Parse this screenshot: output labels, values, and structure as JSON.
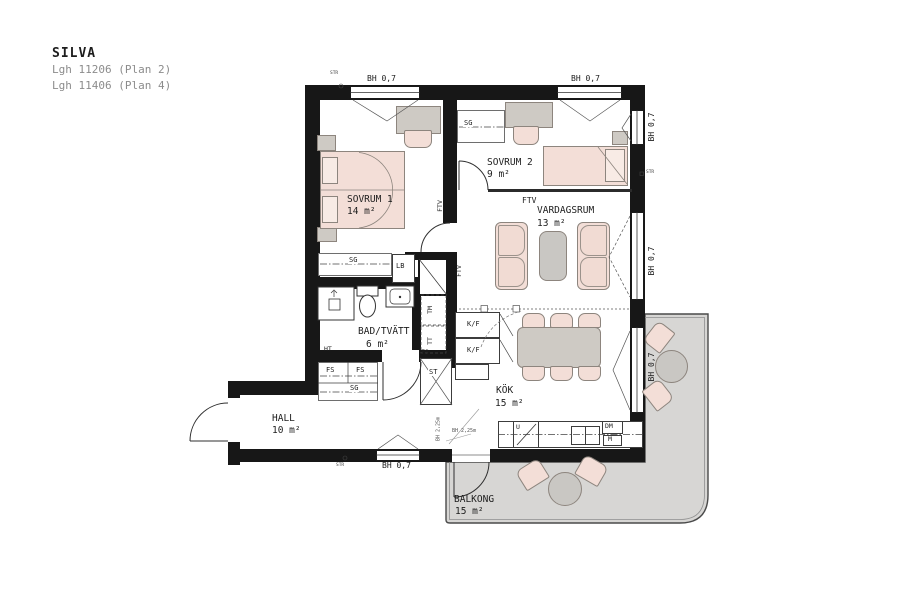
{
  "title": {
    "project": "SILVA",
    "lines": [
      "Lgh 11206 (Plan 2)",
      "Lgh 11406 (Plan 4)"
    ]
  },
  "rooms": {
    "sovrum1": {
      "name": "SOVRUM 1",
      "area": "14 m²"
    },
    "sovrum2": {
      "name": "SOVRUM 2",
      "area": "9 m²"
    },
    "vardagsrum": {
      "name": "VARDAGSRUM",
      "area": "13 m²"
    },
    "bad": {
      "name": "BAD/TVÄTT",
      "area": "6 m²"
    },
    "hall": {
      "name": "HALL",
      "area": "10 m²"
    },
    "kok": {
      "name": "KÖK",
      "area": "15 m²"
    },
    "balkong": {
      "name": "BALKONG",
      "area": "15 m²"
    }
  },
  "labels": {
    "bh07": "BH 0,7",
    "bh225": "BH 2,25m",
    "sg": "SG",
    "lb": "LB",
    "ftv": "FTV",
    "tm": "TM",
    "tt": "TT",
    "fs": "FS",
    "kf": "K/F",
    "st": "ST",
    "ht": "HT",
    "dm": "DM",
    "m": "M",
    "u": "U",
    "str": "STR"
  },
  "colors": {
    "wall": "#171717",
    "furniture_pink": "#f3ded7",
    "furniture_gray": "#cecac4",
    "balcony_floor": "#d7d6d4",
    "outline": "#8d857e",
    "text": "#1d1d1d",
    "muted_text": "#8c8c8c"
  }
}
